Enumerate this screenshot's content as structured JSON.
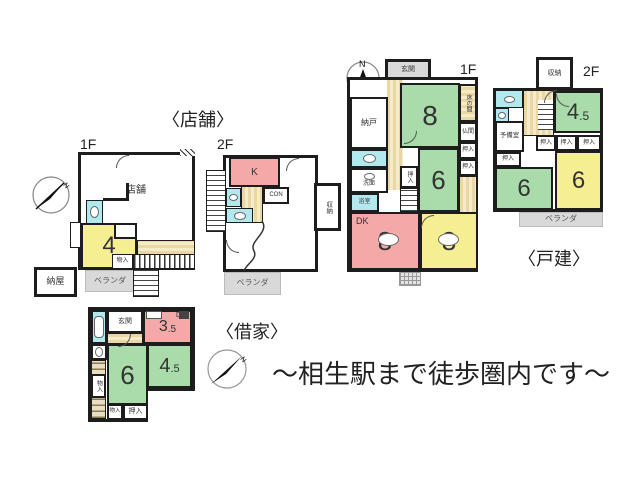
{
  "caption": "〜相生駅まで徒歩圏内です〜",
  "compass_label": "N",
  "nums": {
    "three": "3",
    "four": "4",
    "six": "6",
    "eight": "8",
    "half": ".5"
  },
  "shared": {
    "oshiire": "押入",
    "monoire": "物入",
    "shunou": "収納",
    "veranda": "ベランダ",
    "genkan": "玄関"
  },
  "shop": {
    "title": "〈店舗〉",
    "f1": "1F",
    "f2": "2F",
    "main_room": "店舗",
    "naya": "納屋",
    "kitchen": "K",
    "con": "CON"
  },
  "house": {
    "title": "〈戸建〉",
    "f1": "1F",
    "f2": "2F",
    "nando": "納戸",
    "tokonoma": "床の間",
    "butsuma": "仏間",
    "senmen": "洗面",
    "yokushitsu": "浴室",
    "dk": "DK",
    "yobishitsu": "予備室"
  },
  "rental": {
    "title": "〈借家〉",
    "dk": "DK"
  },
  "colors": {
    "wall": "#1d1d1d",
    "tatami_green": "#aadcab",
    "tatami_yellow": "#f6ee92",
    "dk_pink": "#f4a8a8",
    "wet_cyan": "#b2e9ef",
    "wood": "#ead7a6",
    "veranda_gray": "#d9d9d9"
  }
}
